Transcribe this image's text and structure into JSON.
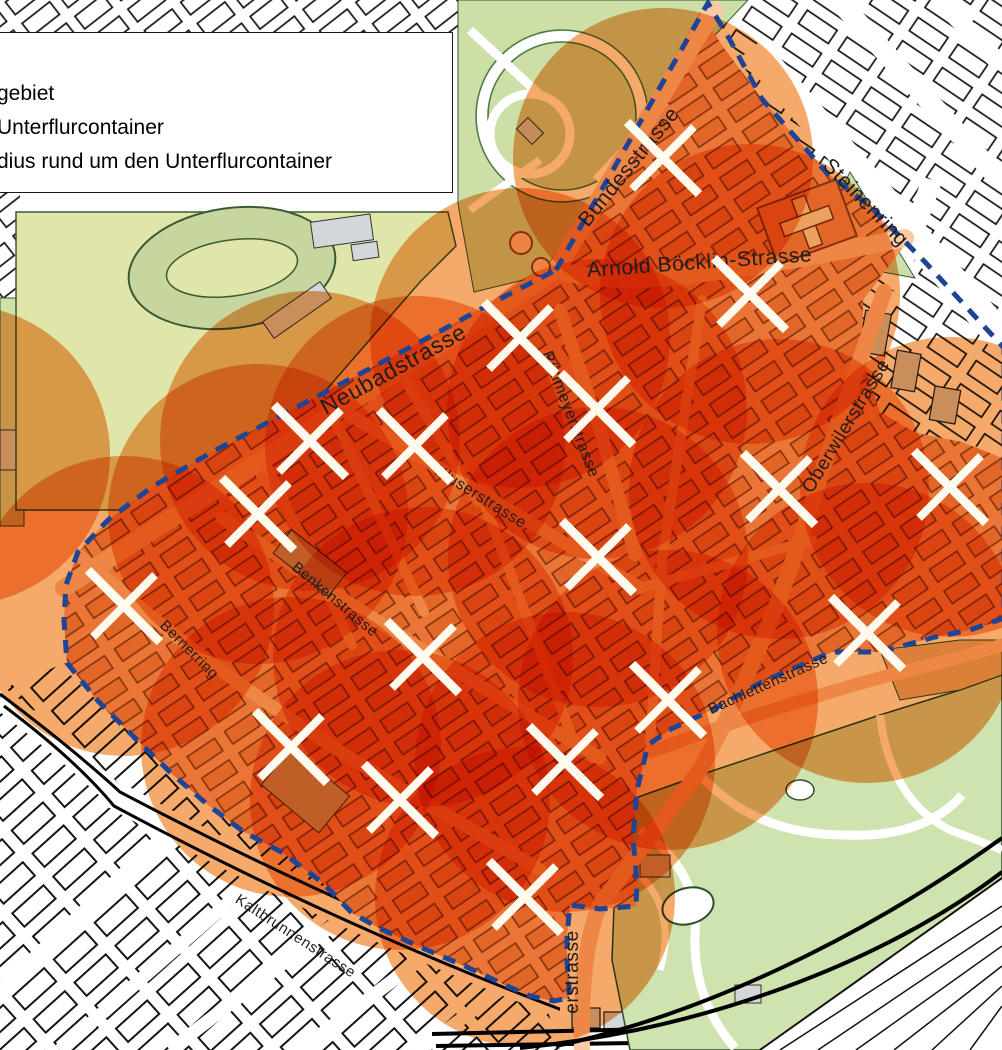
{
  "legend": {
    "items": [
      {
        "label": "gebiet"
      },
      {
        "label": "Unterflurcontainer"
      },
      {
        "label": "dius rund um den Unterflurcontainer"
      }
    ]
  },
  "streets": [
    {
      "name": "Bundesstrasse",
      "x": 634,
      "y": 171,
      "rotate": -51,
      "size": 21
    },
    {
      "name": "Steinenring",
      "x": 861,
      "y": 207,
      "rotate": 46,
      "size": 21
    },
    {
      "name": "Arnold Böcklin-Strasse",
      "x": 700,
      "y": 269,
      "rotate": -4,
      "size": 21
    },
    {
      "name": "Neubadstrasse",
      "x": 397,
      "y": 376,
      "rotate": -29,
      "size": 23
    },
    {
      "name": "Rütimeyerstrasse",
      "x": 566,
      "y": 416,
      "rotate": 69,
      "size": 16
    },
    {
      "name": "Oberwilerstrasse",
      "x": 851,
      "y": 429,
      "rotate": -59,
      "size": 19
    },
    {
      "name": "Kluserstrasse",
      "x": 478,
      "y": 501,
      "rotate": 32,
      "size": 16
    },
    {
      "name": "Benkenstrasse",
      "x": 332,
      "y": 603,
      "rotate": 40,
      "size": 15
    },
    {
      "name": "Bernerring",
      "x": 186,
      "y": 653,
      "rotate": 45,
      "size": 15
    },
    {
      "name": "Bachlettenstrasse",
      "x": 770,
      "y": 688,
      "rotate": -24,
      "size": 15
    },
    {
      "name": "Kaltbrunnenstrasse",
      "x": 293,
      "y": 940,
      "rotate": 33,
      "size": 15
    },
    {
      "name": "erstrasse",
      "x": 578,
      "y": 972,
      "rotate": -90,
      "size": 19
    }
  ],
  "containers": {
    "symbol": "white-x-cross",
    "radius_px": 150,
    "positions": [
      {
        "x": 663,
        "y": 158
      },
      {
        "x": 520,
        "y": 338
      },
      {
        "x": 750,
        "y": 294
      },
      {
        "x": 597,
        "y": 409
      },
      {
        "x": 310,
        "y": 441
      },
      {
        "x": 415,
        "y": 446
      },
      {
        "x": 258,
        "y": 514
      },
      {
        "x": 124,
        "y": 606
      },
      {
        "x": 950,
        "y": 487
      },
      {
        "x": 779,
        "y": 489
      },
      {
        "x": 598,
        "y": 557
      },
      {
        "x": 423,
        "y": 657
      },
      {
        "x": 867,
        "y": 633
      },
      {
        "x": 668,
        "y": 700
      },
      {
        "x": 291,
        "y": 747
      },
      {
        "x": 400,
        "y": 800
      },
      {
        "x": 565,
        "y": 762
      },
      {
        "x": 525,
        "y": 897
      }
    ]
  },
  "extra_radius_circles": [
    {
      "x": -40,
      "y": 455
    }
  ],
  "colors": {
    "pilot_fill": "#F5B183",
    "circle_fill": "#F5A96B",
    "building_fill": "#EC9A5F",
    "building_stroke": "#8A4A1A",
    "street_fill": "#F8CBA3",
    "boundary_blue": "#1E4496",
    "park_green": "#CBDFA7",
    "field_green": "#E0E6A9",
    "track_green": "#C6D69E",
    "zoo_green": "#CFE3AE",
    "grey_fill": "#D3D7DA",
    "cross_white": "#FFFBEE",
    "label_color": "#1D1D1D"
  }
}
